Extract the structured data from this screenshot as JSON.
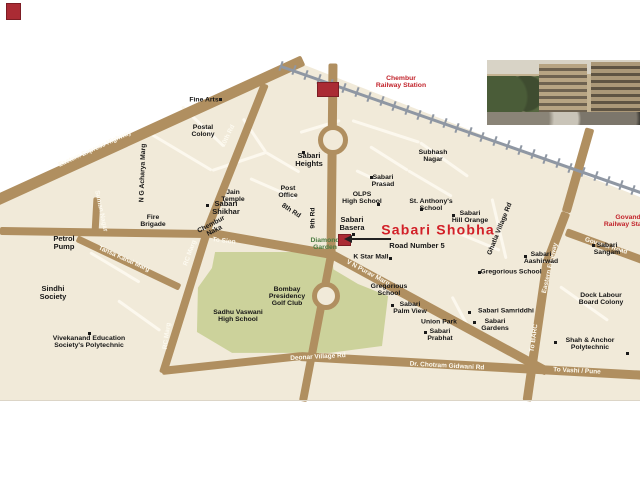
{
  "map": {
    "background_color": "#f1ead9",
    "road_color": "#b08f60",
    "minor_road_color": "#fcf8ee",
    "railway_color": "#8f97a3",
    "green_color": "#ccd29b",
    "text_color": "#161616",
    "red_color": "#c2242c",
    "title": "Sabari Shobha",
    "roads": [
      {
        "x1": -8,
        "y1": 202,
        "x2": 303,
        "y2": 60,
        "w": 11
      },
      {
        "x1": 333,
        "y1": 63,
        "x2": 331,
        "y2": 256,
        "w": 9
      },
      {
        "x1": 265,
        "y1": 84,
        "x2": 207,
        "y2": 230,
        "w": 8
      },
      {
        "x1": 0,
        "y1": 231,
        "x2": 208,
        "y2": 234,
        "w": 8
      },
      {
        "x1": 97,
        "y1": 197,
        "x2": 95,
        "y2": 233,
        "w": 7
      },
      {
        "x1": 206,
        "y1": 232,
        "x2": 332,
        "y2": 254,
        "w": 9
      },
      {
        "x1": 332,
        "y1": 254,
        "x2": 547,
        "y2": 371,
        "w": 9
      },
      {
        "x1": 331,
        "y1": 255,
        "x2": 303,
        "y2": 401,
        "w": 8
      },
      {
        "x1": 207,
        "y1": 232,
        "x2": 163,
        "y2": 373,
        "w": 8
      },
      {
        "x1": 77,
        "y1": 238,
        "x2": 180,
        "y2": 287,
        "w": 7
      },
      {
        "x1": 162,
        "y1": 371,
        "x2": 302,
        "y2": 356,
        "w": 8
      },
      {
        "x1": 300,
        "y1": 356,
        "x2": 648,
        "y2": 375,
        "w": 9
      },
      {
        "x1": 590,
        "y1": 128,
        "x2": 566,
        "y2": 212,
        "w": 9
      },
      {
        "x1": 566,
        "y1": 212,
        "x2": 547,
        "y2": 262,
        "w": 9
      },
      {
        "x1": 547,
        "y1": 262,
        "x2": 527,
        "y2": 401,
        "w": 9
      },
      {
        "x1": 566,
        "y1": 232,
        "x2": 648,
        "y2": 262,
        "w": 8
      }
    ],
    "minor_roads": [
      [
        150,
        133,
        212,
        170
      ],
      [
        182,
        106,
        224,
        146
      ],
      [
        212,
        170,
        266,
        152
      ],
      [
        243,
        118,
        266,
        152
      ],
      [
        266,
        152,
        300,
        172
      ],
      [
        300,
        132,
        340,
        120
      ],
      [
        352,
        120,
        420,
        142
      ],
      [
        420,
        142,
        468,
        176
      ],
      [
        370,
        146,
        408,
        170
      ],
      [
        408,
        170,
        452,
        196
      ],
      [
        250,
        178,
        296,
        198
      ],
      [
        356,
        170,
        390,
        186
      ],
      [
        452,
        230,
        500,
        250
      ],
      [
        492,
        198,
        506,
        258
      ],
      [
        560,
        286,
        608,
        320
      ],
      [
        452,
        296,
        470,
        330
      ],
      [
        90,
        252,
        140,
        282
      ],
      [
        118,
        300,
        160,
        330
      ]
    ],
    "railway": {
      "x1": 281,
      "y1": 66,
      "x2": 646,
      "y2": 194,
      "tick_spacing": 13,
      "tick_len": 10
    },
    "roundabouts": [
      {
        "x": 328,
        "y": 135,
        "r": 10
      },
      {
        "x": 321,
        "y": 291,
        "r": 9
      }
    ],
    "red_boxes": [
      {
        "name": "chembur-station-box",
        "x": 317,
        "y": 82,
        "w": 20,
        "h": 13
      },
      {
        "name": "site-location-box",
        "x": 338,
        "y": 234,
        "w": 11,
        "h": 10
      },
      {
        "name": "logo-mark",
        "x": 6,
        "y": 3,
        "w": 13,
        "h": 15
      }
    ],
    "arrow": {
      "x1": 352,
      "y1": 239,
      "x2": 391,
      "y2": 239
    },
    "road_labels": [
      {
        "text": "Eastern Express Highway",
        "x": 95,
        "y": 149,
        "rot": -24.5
      },
      {
        "text": "10th Rd",
        "x": 228,
        "y": 136,
        "rot": -64
      },
      {
        "text": "Suman Nagar",
        "x": 101,
        "y": 211,
        "rot": 78
      },
      {
        "text": "To Sion",
        "x": 224,
        "y": 241,
        "rot": 7
      },
      {
        "text": "Tansa Kanal Marg",
        "x": 124,
        "y": 259,
        "rot": 24
      },
      {
        "text": "RC Marg",
        "x": 190,
        "y": 253,
        "rot": -70
      },
      {
        "text": "RC Marg",
        "x": 167,
        "y": 336,
        "rot": -82
      },
      {
        "text": "V N Purav Marg",
        "x": 368,
        "y": 273,
        "rot": 28
      },
      {
        "text": "Govandi Road",
        "x": 606,
        "y": 246,
        "rot": 17
      },
      {
        "text": "Eastern Freeway",
        "x": 550,
        "y": 268,
        "rot": -77
      },
      {
        "text": "To BARC",
        "x": 534,
        "y": 338,
        "rot": -82
      },
      {
        "text": "Deonar  Village Rd",
        "x": 318,
        "y": 357,
        "rot": -3
      },
      {
        "text": "Dr. Chotram Gidwani Rd",
        "x": 447,
        "y": 366,
        "rot": 3
      },
      {
        "text": "To Vashi / Pune",
        "x": 577,
        "y": 371,
        "rot": 3
      }
    ],
    "places": [
      {
        "lines": [
          "Fine Arts"
        ],
        "x": 204,
        "y": 100
      },
      {
        "lines": [
          "Postal",
          "Colony"
        ],
        "x": 203,
        "y": 131
      },
      {
        "lines": [
          "Sabari",
          "Heights"
        ],
        "x": 309,
        "y": 160,
        "size": 7.5
      },
      {
        "lines": [
          "Subhash",
          "Nagar"
        ],
        "x": 433,
        "y": 156
      },
      {
        "lines": [
          "Sabari",
          "Prasad"
        ],
        "x": 383,
        "y": 181
      },
      {
        "lines": [
          "Jain",
          "Temple"
        ],
        "x": 233,
        "y": 196
      },
      {
        "lines": [
          "Post",
          "Office"
        ],
        "x": 288,
        "y": 192
      },
      {
        "lines": [
          "Sabari",
          "Shikhar"
        ],
        "x": 226,
        "y": 208,
        "size": 7.5
      },
      {
        "lines": [
          "Fire",
          "Brigade"
        ],
        "x": 153,
        "y": 221
      },
      {
        "lines": [
          "OLPS",
          "High School"
        ],
        "x": 362,
        "y": 198
      },
      {
        "lines": [
          "St. Anthony's",
          "School"
        ],
        "x": 431,
        "y": 205
      },
      {
        "lines": [
          "Sabari",
          "Hill Orange"
        ],
        "x": 470,
        "y": 217
      },
      {
        "lines": [
          "Sabari",
          "Basera"
        ],
        "x": 352,
        "y": 224,
        "size": 7.5
      },
      {
        "lines": [
          "Sabari Shobha"
        ],
        "x": 438,
        "y": 230,
        "color": "#d21f27",
        "size": 14,
        "spacing": 1.2
      },
      {
        "lines": [
          "Road Number 5"
        ],
        "x": 417,
        "y": 246,
        "size": 7.5
      },
      {
        "lines": [
          "K Star Mall"
        ],
        "x": 371,
        "y": 257
      },
      {
        "lines": [
          "Diamond",
          "Garden"
        ],
        "x": 325,
        "y": 244,
        "color": "#4b7c42"
      },
      {
        "lines": [
          "Petrol",
          "Pump"
        ],
        "x": 64,
        "y": 243,
        "size": 7.5
      },
      {
        "lines": [
          "Sindhi",
          "Society"
        ],
        "x": 53,
        "y": 293,
        "size": 7.5
      },
      {
        "lines": [
          "Vivekanand Education",
          "Society's Polytechnic"
        ],
        "x": 89,
        "y": 342
      },
      {
        "lines": [
          "Sadhu Vaswani",
          "High School"
        ],
        "x": 238,
        "y": 316
      },
      {
        "lines": [
          "Bombay",
          "Presidency",
          "Golf Club"
        ],
        "x": 287,
        "y": 297
      },
      {
        "lines": [
          "Gregorious",
          "School"
        ],
        "x": 389,
        "y": 290
      },
      {
        "lines": [
          "Sabari",
          "Palm View"
        ],
        "x": 410,
        "y": 308
      },
      {
        "lines": [
          "Union Park"
        ],
        "x": 439,
        "y": 322
      },
      {
        "lines": [
          "Sabari",
          "Prabhat"
        ],
        "x": 440,
        "y": 335
      },
      {
        "lines": [
          "Gregorious School"
        ],
        "x": 511,
        "y": 272
      },
      {
        "lines": [
          "Sabari",
          "Aashirwad"
        ],
        "x": 541,
        "y": 258
      },
      {
        "lines": [
          "Sabari",
          "Sangam"
        ],
        "x": 607,
        "y": 249
      },
      {
        "lines": [
          "Dock Labour",
          "Board Colony"
        ],
        "x": 601,
        "y": 299
      },
      {
        "lines": [
          "Sabari Samriddhi"
        ],
        "x": 506,
        "y": 311
      },
      {
        "lines": [
          "Sabari",
          "Gardens"
        ],
        "x": 495,
        "y": 325
      },
      {
        "lines": [
          "Shah & Anchor",
          "Polytechnic"
        ],
        "x": 590,
        "y": 344
      },
      {
        "lines": [
          "Chembur",
          "Railway Station"
        ],
        "x": 401,
        "y": 82,
        "color": "#c2242c"
      },
      {
        "lines": [
          "Govandi",
          "Railway Station"
        ],
        "x": 629,
        "y": 221,
        "color": "#c2242c"
      },
      {
        "lines": [
          "Chembur",
          "Naka"
        ],
        "x": 213,
        "y": 228,
        "rot": -28
      },
      {
        "lines": [
          "8th Rd"
        ],
        "x": 291,
        "y": 211,
        "rot": 33
      },
      {
        "lines": [
          "9th Rd"
        ],
        "x": 313,
        "y": 218,
        "rot": -90
      },
      {
        "lines": [
          "Ghatla Village Rd"
        ],
        "x": 500,
        "y": 229,
        "rot": -68
      },
      {
        "lines": [
          "N G Acharya Marg"
        ],
        "x": 143,
        "y": 173,
        "rot": -88
      }
    ],
    "markers": [
      [
        219,
        98
      ],
      [
        302,
        151
      ],
      [
        370,
        176
      ],
      [
        206,
        204
      ],
      [
        377,
        203
      ],
      [
        420,
        208
      ],
      [
        452,
        214
      ],
      [
        352,
        233
      ],
      [
        389,
        257
      ],
      [
        391,
        304
      ],
      [
        424,
        331
      ],
      [
        468,
        311
      ],
      [
        473,
        321
      ],
      [
        592,
        244
      ],
      [
        524,
        255
      ],
      [
        554,
        341
      ],
      [
        478,
        271
      ],
      [
        88,
        332
      ],
      [
        626,
        352
      ]
    ]
  }
}
